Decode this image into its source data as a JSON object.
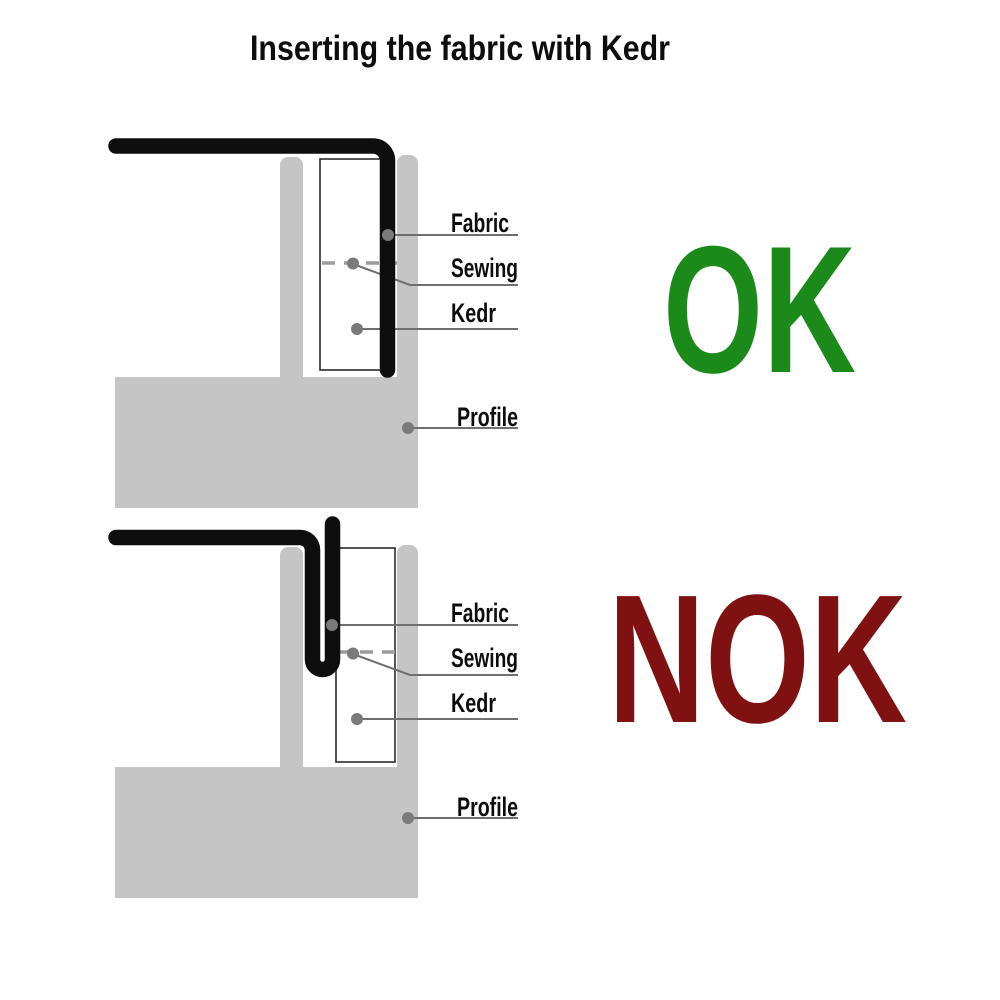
{
  "title": "Inserting the fabric with Kedr",
  "diagrams": {
    "ok": {
      "verdict": "OK",
      "callouts": {
        "fabric": "Fabric",
        "sewing": "Sewing",
        "kedr": "Kedr",
        "profile": "Profile"
      }
    },
    "nok": {
      "verdict": "NOK",
      "callouts": {
        "fabric": "Fabric",
        "sewing": "Sewing",
        "kedr": "Kedr",
        "profile": "Profile"
      }
    }
  },
  "colors": {
    "ok_green": "#1b8a1b",
    "nok_red": "#7f1113",
    "profile_gray": "#c5c5c5",
    "fabric_black": "#0e0e0e",
    "callout_line_gray": "#6f6f6f",
    "marker_dot_gray": "#7a7a7a",
    "sewing_dash_gray": "#9b9b9b",
    "kedr_outline": "#2b2b2b",
    "text_black": "#0d0d0d",
    "background_white": "#ffffff"
  }
}
